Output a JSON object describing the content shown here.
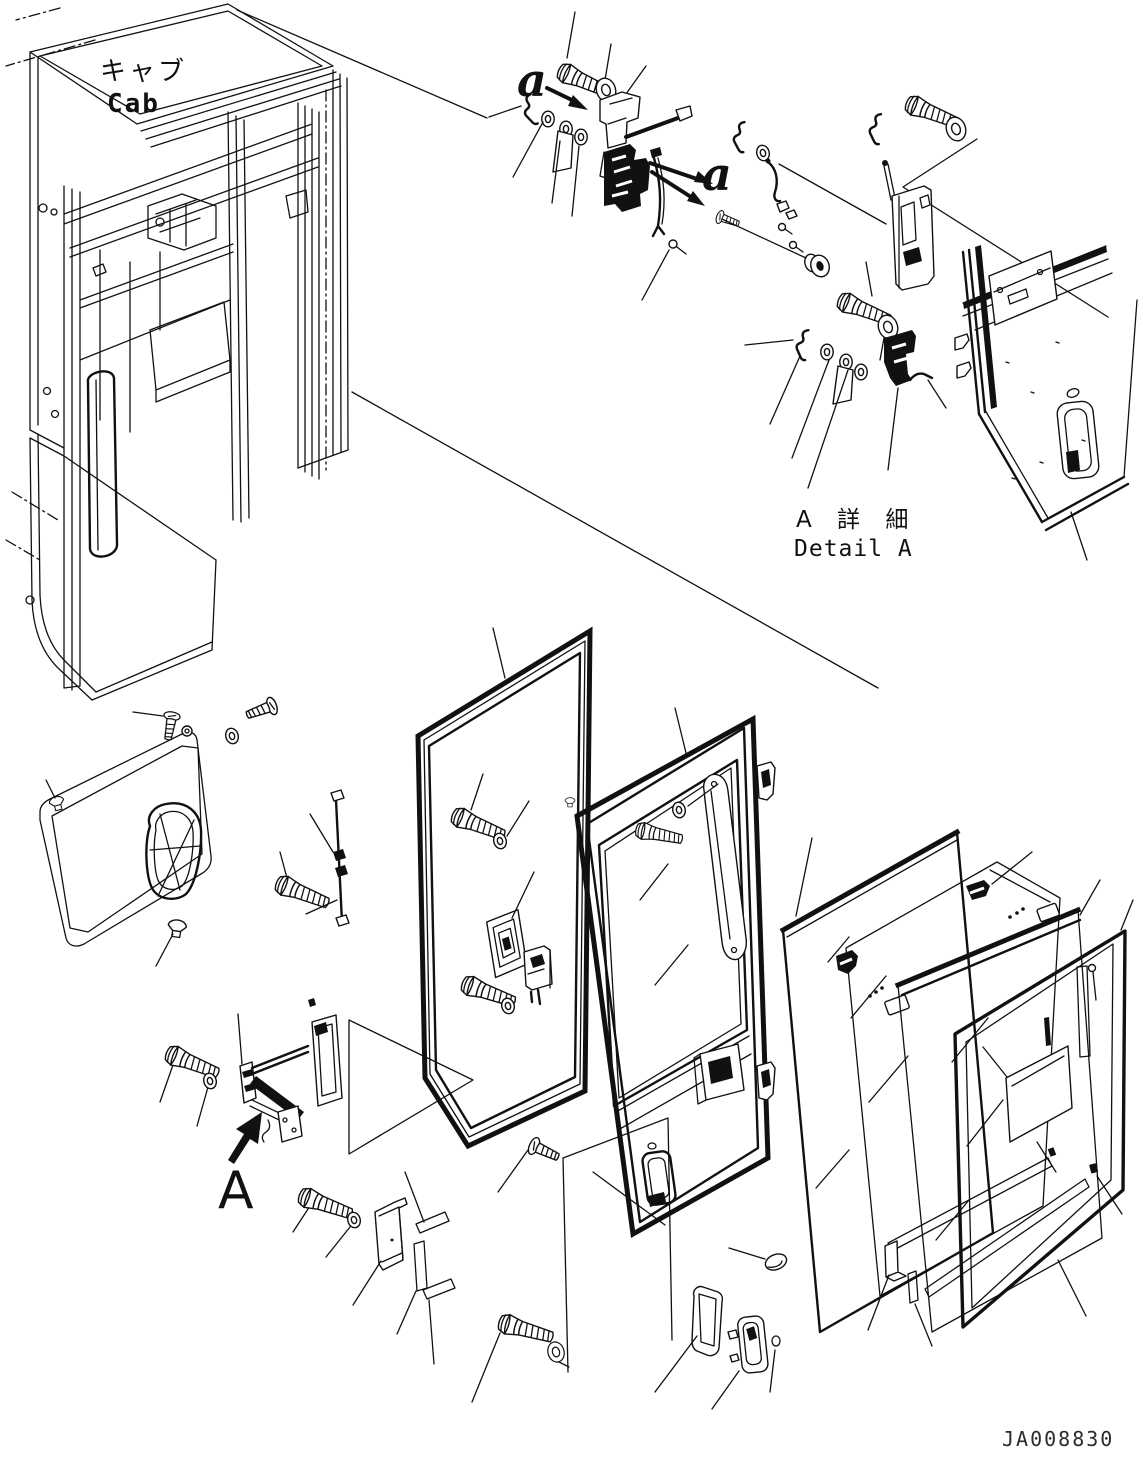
{
  "document": {
    "kind": "exploded-parts-diagram",
    "drawing_number": "JA008830"
  },
  "labels": {
    "cab_jp": "キャブ",
    "cab_en": "Cab",
    "detail_a_jp": "A 詳 細",
    "detail_a_en": "Detail A",
    "section_marker_upper": "a",
    "section_marker_lower": "a",
    "detail_marker": "A"
  },
  "colors": {
    "line": "#111111",
    "background": "#ffffff"
  }
}
